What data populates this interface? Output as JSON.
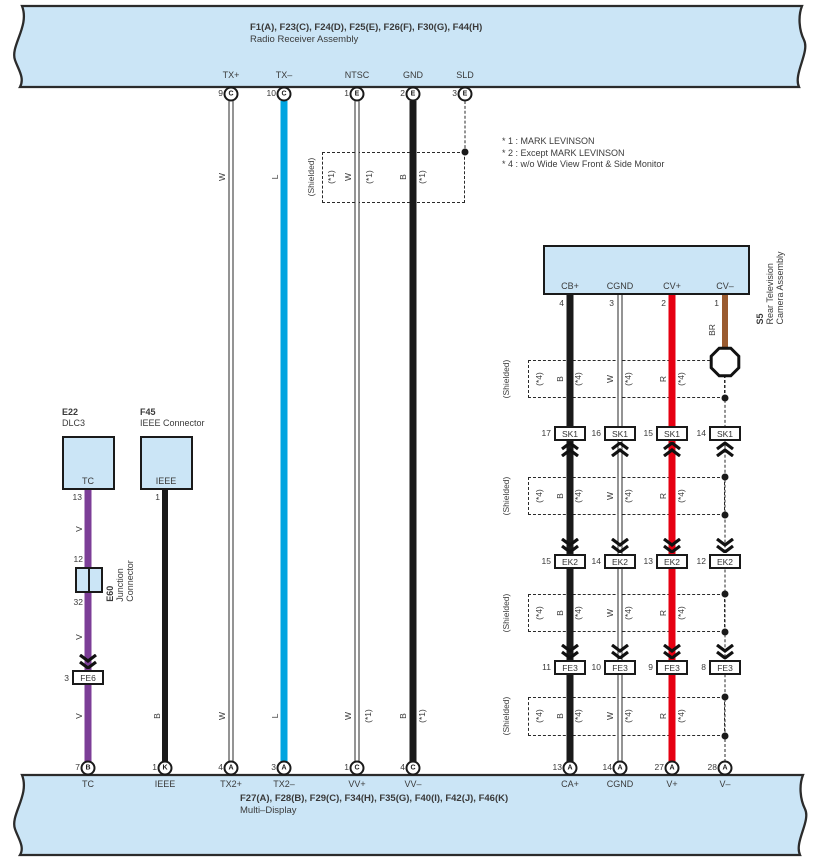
{
  "top_banner": {
    "title": "F1(A), F23(C), F24(D), F25(E), F26(F), F30(G), F44(H)",
    "subtitle": "Radio Receiver Assembly",
    "pins": [
      {
        "label": "TX+",
        "num": "9",
        "conn": "C"
      },
      {
        "label": "TX–",
        "num": "10",
        "conn": "C"
      },
      {
        "label": "NTSC",
        "num": "1",
        "conn": "E"
      },
      {
        "label": "GND",
        "num": "2",
        "conn": "E"
      },
      {
        "label": "SLD",
        "num": "3",
        "conn": "E"
      }
    ]
  },
  "bottom_banner": {
    "title": "F27(A), F28(B), F29(C), F34(H), F35(G), F40(I), F42(J), F46(K)",
    "subtitle": "Multi–Display",
    "pins": [
      {
        "label": "TC",
        "num": "7",
        "conn": "B"
      },
      {
        "label": "IEEE",
        "num": "1",
        "conn": "K"
      },
      {
        "label": "TX2+",
        "num": "4",
        "conn": "A"
      },
      {
        "label": "TX2–",
        "num": "3",
        "conn": "A"
      },
      {
        "label": "VV+",
        "num": "1",
        "conn": "C"
      },
      {
        "label": "VV–",
        "num": "4",
        "conn": "C"
      },
      {
        "label": "CA+",
        "num": "13",
        "conn": "A"
      },
      {
        "label": "CGND",
        "num": "14",
        "conn": "A"
      },
      {
        "label": "V+",
        "num": "27",
        "conn": "A"
      },
      {
        "label": "V–",
        "num": "28",
        "conn": "A"
      }
    ]
  },
  "notes": [
    "* 1 : MARK LEVINSON",
    "* 2 : Except MARK LEVINSON",
    "* 4 : w/o Wide View Front & Side Monitor"
  ],
  "camera": {
    "id": "S5",
    "name1": "Rear Television",
    "name2": "Camera Assembly",
    "pins": [
      {
        "label": "CB+",
        "num": "4"
      },
      {
        "label": "CGND",
        "num": "3"
      },
      {
        "label": "CV+",
        "num": "2"
      },
      {
        "label": "CV–",
        "num": "1"
      }
    ]
  },
  "e22": {
    "id": "E22",
    "name": "DLC3",
    "terminal": "TC",
    "pin": "13"
  },
  "f45": {
    "id": "F45",
    "name": "IEEE Connector",
    "terminal": "IEEE",
    "pin": "1"
  },
  "junction": {
    "id": "E60",
    "name1": "Junction",
    "name2": "Connector",
    "pin_top": "12",
    "pin_bottom": "32"
  },
  "fe6": {
    "pin": "3",
    "label": "FE6"
  },
  "rows": {
    "sk1": {
      "label": "SK1",
      "pins": [
        "17",
        "16",
        "15",
        "14"
      ]
    },
    "ek2": {
      "label": "EK2",
      "pins": [
        "15",
        "14",
        "13",
        "12"
      ]
    },
    "fe3": {
      "label": "FE3",
      "pins": [
        "11",
        "10",
        "9",
        "8"
      ]
    }
  },
  "labels": {
    "shielded": "(Shielded)",
    "s1": "(*1)",
    "s4": "(*4)",
    "w": "W",
    "l": "L",
    "b": "B",
    "v": "V",
    "r": "R",
    "br": "BR"
  },
  "colors": {
    "banner_fill": "#cbe5f6",
    "wire_black": "#1a1a1a",
    "wire_cyan": "#00a4e0",
    "wire_purple": "#7c3e97",
    "wire_red": "#e60012",
    "wire_brown": "#9a5b30"
  }
}
